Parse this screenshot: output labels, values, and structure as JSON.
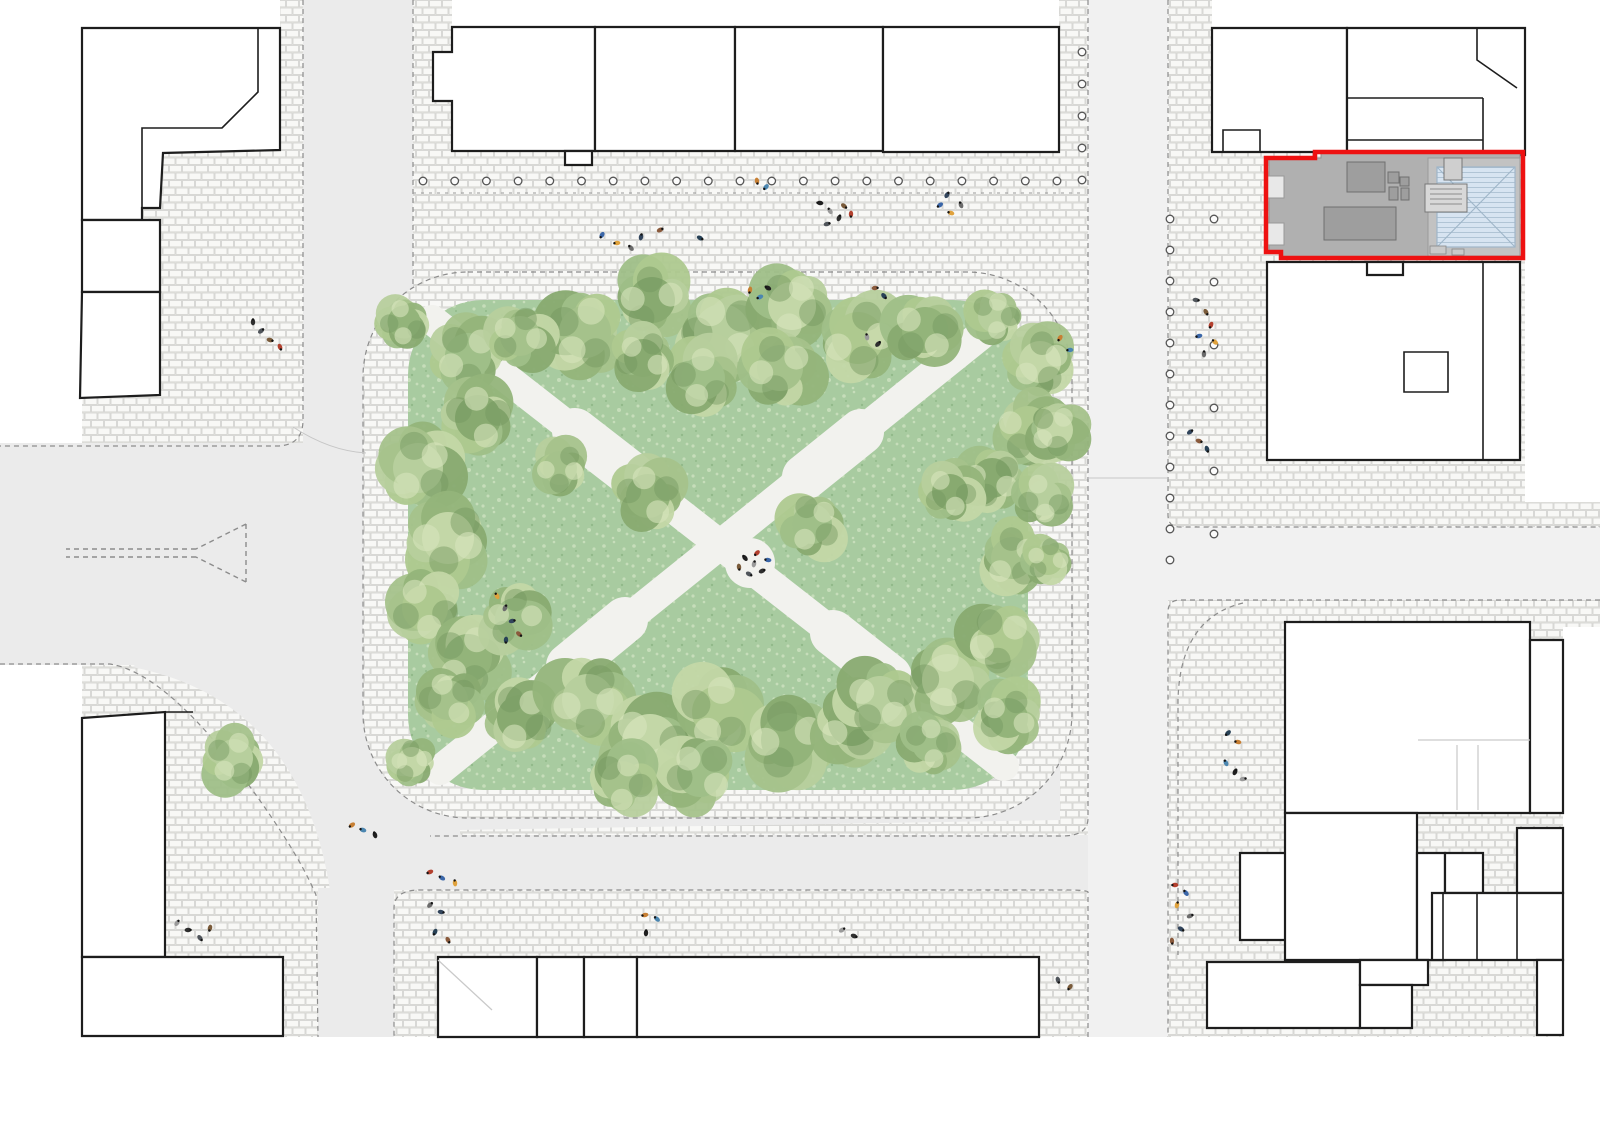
{
  "meta": {
    "title": "Urban square site plan",
    "drawing_type": "architectural-site-plan",
    "view": "top-down roof plan"
  },
  "colors": {
    "road": "#ebebeb",
    "road_light": "#f1f1f1",
    "cobble_base": "#f4f4f2",
    "cobble_stone": "#f8f8f6",
    "cobble_joint": "#d2d2ce",
    "lawn": "#a8cba0",
    "lawn_dot_light": "#c6ddba",
    "lawn_dot_dark": "#92b98a",
    "path": "#f2f2ee",
    "building_fill": "#ffffff",
    "building_stroke": "#1d1d1d",
    "dash": "#8c8c8c",
    "curb": "#c6c6c6",
    "site_outline": "#ee1111",
    "site_gray": "#b0b0b0",
    "site_gray_dark": "#9e9e9e",
    "site_line": "#6f6f6f",
    "roof_blue": "#d7e4f1",
    "roof_blue_line": "#9fb6c9",
    "bollard": "#555555",
    "tree_dark": "#74975f",
    "tree_hi": "#d7e5bd",
    "tree_palette": [
      "#b7cf9d",
      "#a5c28b",
      "#93b47a",
      "#c3d7a7",
      "#88aa70",
      "#9fbf88",
      "#aec98f"
    ],
    "people_palette": [
      "#2e2e2e",
      "#50555b",
      "#7a5b3a",
      "#b3402e",
      "#3a66a8",
      "#e0a23c",
      "#6b6b6b",
      "#32455c",
      "#8a5a3c",
      "#274156",
      "#c77f33",
      "#4b86b0",
      "#1f1f1f",
      "#9a9a9a"
    ]
  },
  "site": {
    "name": "project-site",
    "outline_color": "#ee1111",
    "roof_type": "hipped glass roof with roof terrace"
  },
  "park": {
    "shape": "rounded square",
    "paths": "diagonal cross",
    "tree_count": 46
  },
  "trees": [
    [
      585,
      332,
      52
    ],
    [
      652,
      300,
      46
    ],
    [
      722,
      332,
      56
    ],
    [
      792,
      306,
      48
    ],
    [
      858,
      338,
      52
    ],
    [
      925,
      330,
      46
    ],
    [
      703,
      378,
      44
    ],
    [
      780,
      368,
      46
    ],
    [
      643,
      358,
      38
    ],
    [
      995,
      316,
      34
    ],
    [
      1040,
      362,
      42
    ],
    [
      1028,
      428,
      44
    ],
    [
      404,
      322,
      33
    ],
    [
      468,
      356,
      46
    ],
    [
      520,
      336,
      40
    ],
    [
      478,
      418,
      46
    ],
    [
      418,
      468,
      50
    ],
    [
      448,
      538,
      52
    ],
    [
      425,
      608,
      46
    ],
    [
      468,
      658,
      48
    ],
    [
      515,
      618,
      40
    ],
    [
      448,
      700,
      40
    ],
    [
      520,
      718,
      46
    ],
    [
      588,
      700,
      52
    ],
    [
      650,
      742,
      56
    ],
    [
      718,
      712,
      52
    ],
    [
      788,
      740,
      54
    ],
    [
      700,
      774,
      46
    ],
    [
      622,
      782,
      42
    ],
    [
      852,
      722,
      48
    ],
    [
      880,
      700,
      48
    ],
    [
      948,
      680,
      52
    ],
    [
      1000,
      640,
      46
    ],
    [
      1008,
      718,
      40
    ],
    [
      930,
      744,
      36
    ],
    [
      1012,
      558,
      42
    ],
    [
      992,
      478,
      40
    ],
    [
      1044,
      498,
      36
    ],
    [
      1055,
      430,
      36
    ],
    [
      1048,
      560,
      30
    ],
    [
      648,
      496,
      44
    ],
    [
      812,
      524,
      40
    ],
    [
      560,
      468,
      34
    ],
    [
      950,
      492,
      36
    ],
    [
      234,
      758,
      38
    ],
    [
      412,
      762,
      30
    ]
  ],
  "people": [
    [
      253,
      322
    ],
    [
      261,
      331
    ],
    [
      270,
      340
    ],
    [
      280,
      347
    ],
    [
      602,
      235
    ],
    [
      617,
      243
    ],
    [
      631,
      248
    ],
    [
      641,
      237
    ],
    [
      660,
      230
    ],
    [
      700,
      238
    ],
    [
      757,
      181
    ],
    [
      766,
      187
    ],
    [
      820,
      203
    ],
    [
      830,
      211
    ],
    [
      839,
      218
    ],
    [
      827,
      224
    ],
    [
      844,
      206
    ],
    [
      851,
      214
    ],
    [
      940,
      205
    ],
    [
      951,
      213
    ],
    [
      961,
      205
    ],
    [
      947,
      195
    ],
    [
      875,
      288
    ],
    [
      884,
      296
    ],
    [
      750,
      290
    ],
    [
      760,
      297
    ],
    [
      768,
      288
    ],
    [
      867,
      337
    ],
    [
      878,
      344
    ],
    [
      1196,
      300
    ],
    [
      1206,
      312
    ],
    [
      1211,
      325
    ],
    [
      1199,
      336
    ],
    [
      1215,
      342
    ],
    [
      1204,
      354
    ],
    [
      1190,
      432
    ],
    [
      1199,
      441
    ],
    [
      1207,
      449
    ],
    [
      1060,
      338
    ],
    [
      1070,
      350
    ],
    [
      745,
      558
    ],
    [
      754,
      564
    ],
    [
      762,
      571
    ],
    [
      749,
      574
    ],
    [
      739,
      567
    ],
    [
      757,
      553
    ],
    [
      768,
      560
    ],
    [
      497,
      596
    ],
    [
      505,
      608
    ],
    [
      512,
      621
    ],
    [
      519,
      634
    ],
    [
      506,
      640
    ],
    [
      352,
      825
    ],
    [
      363,
      830
    ],
    [
      375,
      835
    ],
    [
      177,
      923
    ],
    [
      188,
      930
    ],
    [
      200,
      938
    ],
    [
      210,
      928
    ],
    [
      430,
      872
    ],
    [
      442,
      878
    ],
    [
      455,
      883
    ],
    [
      430,
      905
    ],
    [
      441,
      912
    ],
    [
      448,
      940
    ],
    [
      435,
      932
    ],
    [
      645,
      915
    ],
    [
      657,
      919
    ],
    [
      646,
      933
    ],
    [
      842,
      930
    ],
    [
      854,
      936
    ],
    [
      1058,
      980
    ],
    [
      1070,
      987
    ],
    [
      1175,
      885
    ],
    [
      1186,
      893
    ],
    [
      1177,
      905
    ],
    [
      1190,
      916
    ],
    [
      1181,
      929
    ],
    [
      1172,
      941
    ],
    [
      1228,
      733
    ],
    [
      1238,
      742
    ],
    [
      1226,
      763
    ],
    [
      1235,
      772
    ],
    [
      1243,
      779
    ]
  ],
  "bollards": {
    "rows": [
      {
        "x": 423,
        "y": 181,
        "dx": 31.7,
        "dy": 0,
        "n": 21
      },
      {
        "x": 1082,
        "y": 52,
        "dx": 0,
        "dy": 32,
        "n": 5
      },
      {
        "x": 1170,
        "y": 219,
        "dx": 0,
        "dy": 31,
        "n": 12
      },
      {
        "x": 1214,
        "y": 219,
        "dx": 0,
        "dy": 63,
        "n": 6
      }
    ]
  }
}
